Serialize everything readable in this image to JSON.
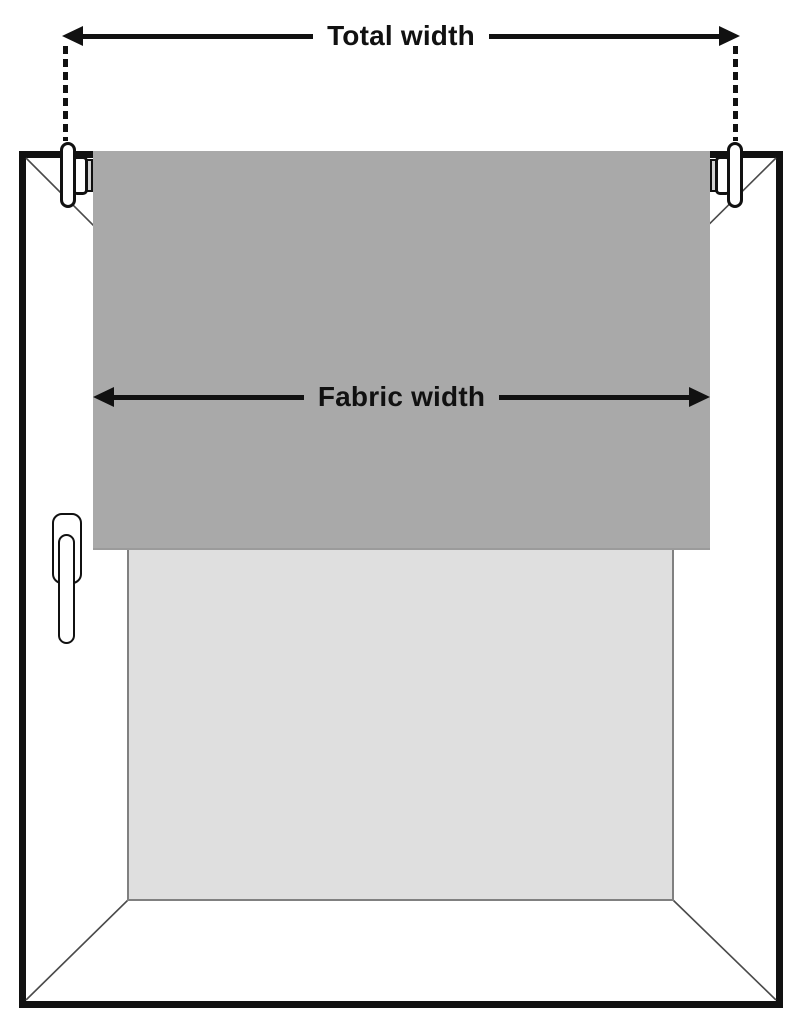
{
  "diagram": {
    "type": "roller-blind-measurement-guide",
    "labels": {
      "total_width": "Total width",
      "fabric_width": "Fabric width"
    },
    "colors": {
      "background": "#ffffff",
      "outline": "#111111",
      "fabric": "#a9a9a9",
      "glass": "#dfdfdf",
      "glass_border": "#808080",
      "miter_line": "#4a4a4a",
      "roller_end": "#d4d4d4"
    }
  }
}
